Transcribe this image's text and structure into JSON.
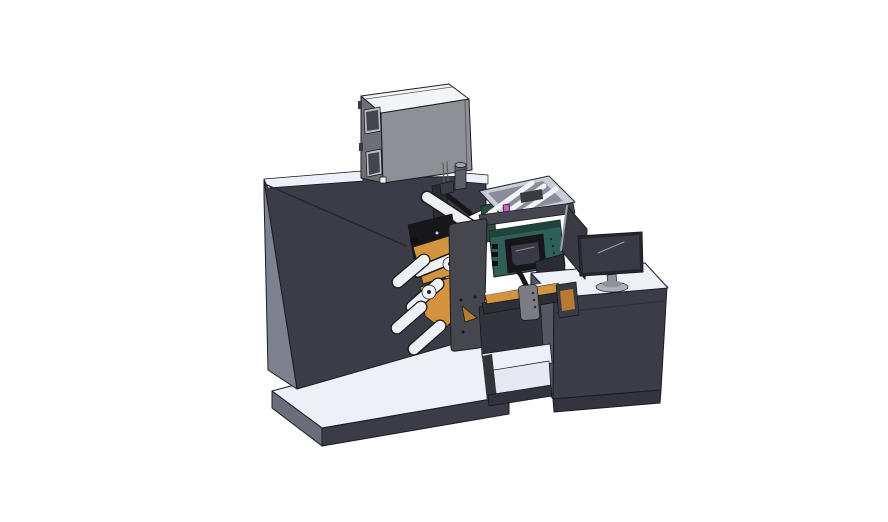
{
  "scene": {
    "description": "3D CAD isometric render of an industrial label printing machine: large dark cabinet with electronics box on top, web rollers with orange material, enclosed print unit, conveyor bridge and an operator desk with monitor",
    "canvas": {
      "width": 888,
      "height": 522
    }
  },
  "colors": {
    "background": "#ffffff",
    "outline_black": "#1a1a1a",
    "seam_dark": "#26262e",
    "top_surface": "#edf0f7",
    "highlight": "#f2f4f9",
    "bay_white": "#e6e9f1",
    "cabinet_front": "#3c3c48",
    "cabinet_side": "#7e8290",
    "base_side": "#6a6d7a",
    "box_front": "#8e9096",
    "box_side": "#6f7076",
    "box_top": "#f3f4f8",
    "box_window": "#43444c",
    "window_frame": "#b9bcc4",
    "slot_gray": "#5a5b62",
    "metal_gray": "#5d5e66",
    "metal_light": "#9fa2ac",
    "plate_gray": "#46464f",
    "mech_black": "#17171b",
    "mech_dark2": "#2b2b33",
    "gear_inner": "#3a3a42",
    "dot_gray": "#cfd2da",
    "roller_white": "#eef0f6",
    "orange": "#d4943f",
    "orange_dark": "#b87a33",
    "teal": "#2f5f56",
    "teal_dark": "#1f443c",
    "teal_glint": "#8b8e99",
    "vent_dark": "#142e28",
    "btn_black": "#101014",
    "glass": "#c7ccd8",
    "glass_inner": "#8b8e9a",
    "magenta": "#c95fc1",
    "pcb_green": "#2c4a40",
    "pendant_gray": "#7b7b84",
    "dots_dark": "#2e2e36",
    "stand_dark": "#33333d",
    "rail_dark": "#2e2e37",
    "desk_side": "#565662",
    "plinth_dark": "#34343e",
    "desk_seam": "#2e2e38",
    "screen_dark": "#26262e",
    "screen_face": "#3a3a44",
    "glint_gray": "#9a9da8",
    "monitor_base": "#aeb1bc",
    "monitor_neck": "#8e919c"
  }
}
